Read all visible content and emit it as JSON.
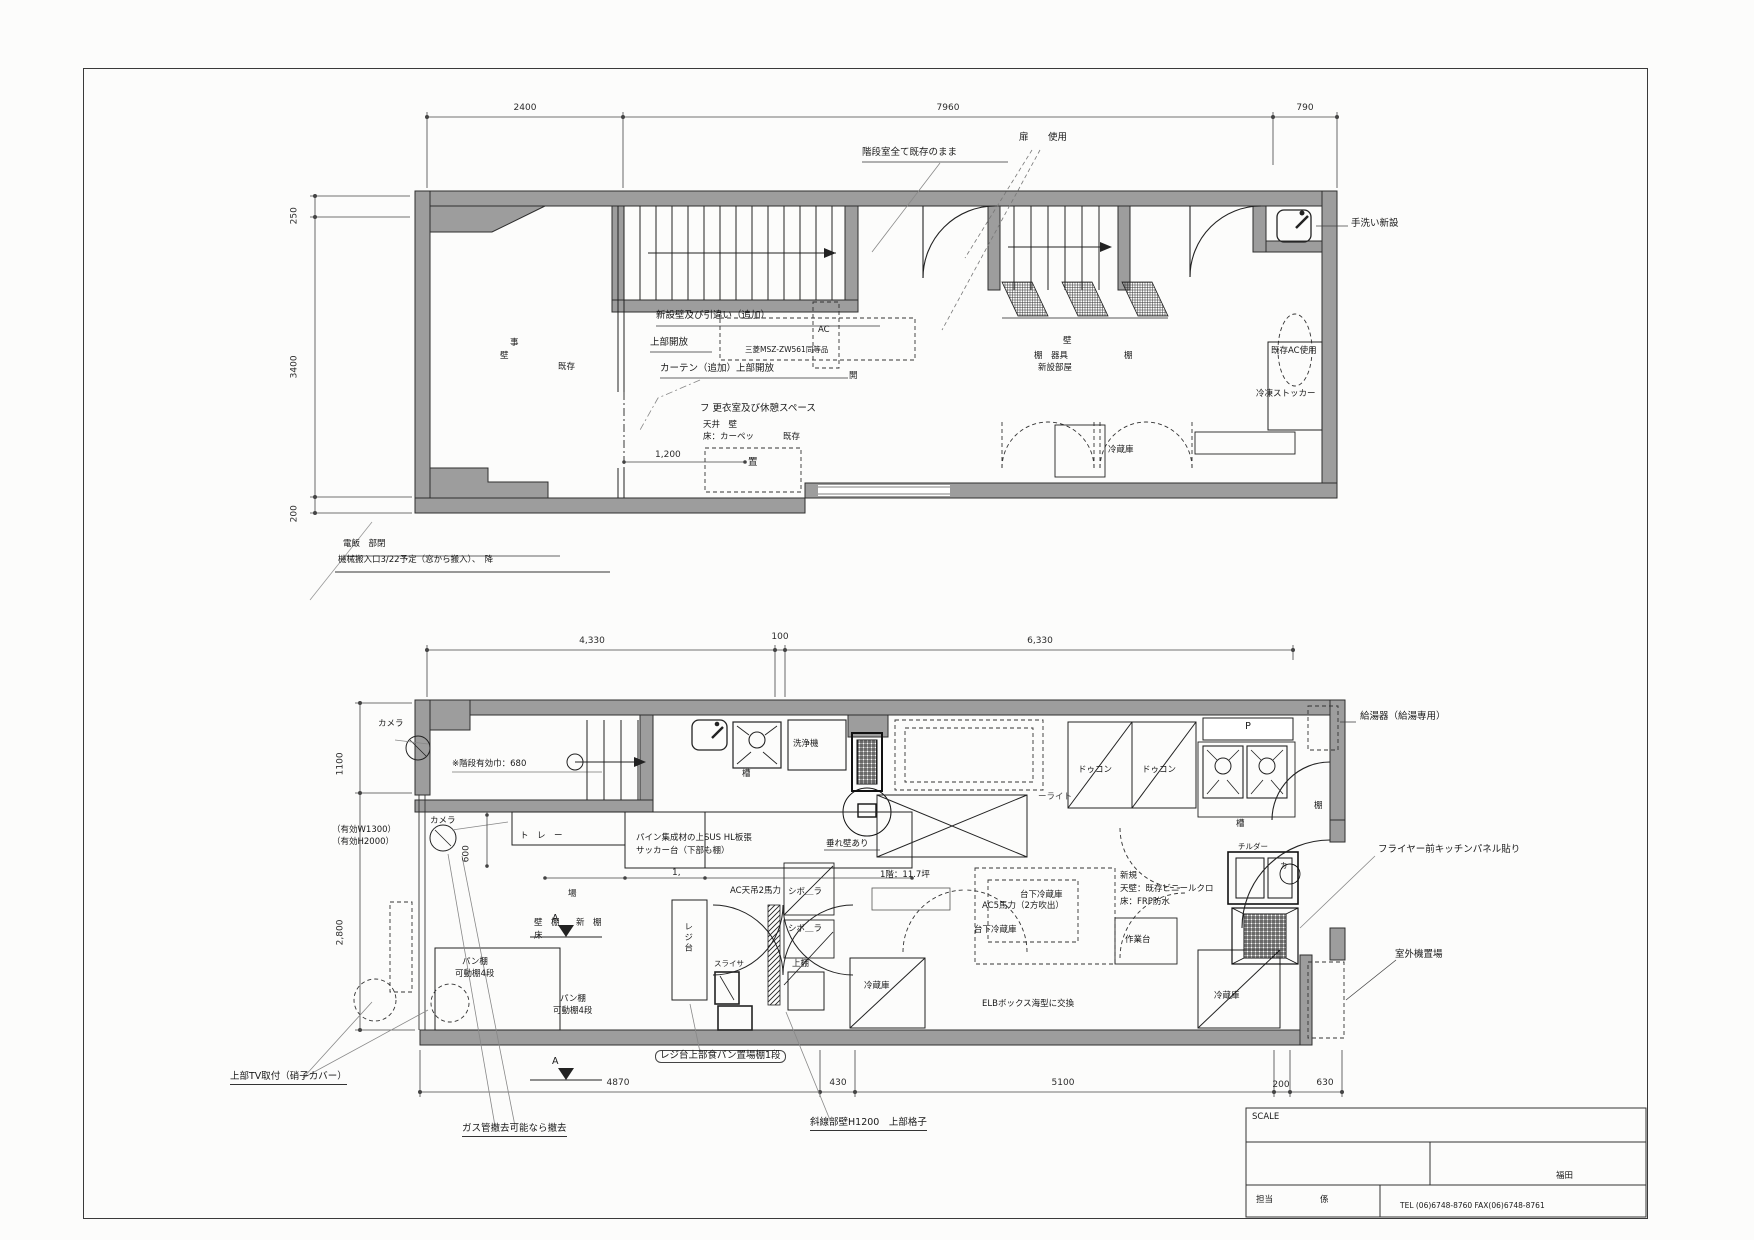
{
  "sheet": {
    "titleblock": {
      "scale": "SCALE",
      "tanto": "担当",
      "kakari": "係",
      "name": "福田",
      "tel": "TEL (06)6748-8760  FAX(06)6748-8761"
    },
    "notes": {
      "note1a": "電飯　部閉",
      "note1b": "機械搬入口3/22予定（窓から搬入）、　降",
      "tv": "上部TV取付（硝子カバー）",
      "gas": "ガス管撤去可能なら撤去",
      "breadshelf": "レジ台上部食パン置場棚1段",
      "hatch": "斜線部壁H1200　上部格子"
    }
  },
  "plan2f": {
    "dims": {
      "top1": "2400",
      "top2": "7960",
      "top3": "790",
      "left1": "250",
      "left2": "3400",
      "left3": "200",
      "inner": "1,200"
    },
    "labels": {
      "stair_note": "階段室全て既存のまま",
      "door": "扉",
      "door_use": "使用",
      "handwash": "手洗い新設",
      "new_wall": "新設壁及び引違い（追加）",
      "upper_open": "上部開放",
      "curtain": "カーテン（追加）上部開放",
      "dressing": "フ 更衣室及び休憩スペース",
      "ceiling_wall": "天井　壁",
      "floor_carpet": "床：カーペッ",
      "existing1": "既存",
      "room_a": "事",
      "room_b": "壁",
      "room_c": "既存",
      "ac": "AC",
      "ac_model": "三菱MSZ-ZW561同等品",
      "open_char": "開",
      "wall2": "壁",
      "shelf_fixture": "棚　器具",
      "new_room": "新設部屋",
      "shelf2": "棚",
      "exist_ac": "既存AC使用",
      "freezer": "冷凍ストッカー",
      "oki": "置",
      "fridge": "冷蔵庫"
    }
  },
  "plan1f": {
    "dims": {
      "t1": "4,330",
      "t2": "100",
      "t3": "6,330",
      "b1": "4870",
      "b2": "430",
      "b3": "5100",
      "b4": "200",
      "b5": "630",
      "l1": "1100",
      "l2": "2,800",
      "v600": "600",
      "v1": "1,"
    },
    "labels": {
      "water_heater": "給湯器（給湯専用）",
      "camera1": "カメラ",
      "camera2": "カメラ",
      "stair_width": "※階段有効巾：680",
      "eff_w": "（有効W1300）",
      "eff_h": "（有効H2000）",
      "tray": "ト　レ　ー",
      "counter1": "パイン集成材の上SUS HL板張",
      "counter2": "サッカー台（下部も棚）",
      "washer": "洗浄機",
      "tank1": "槽",
      "tank2": "槽",
      "deck1": "ドゥコン",
      "deck2": "ドゥコン",
      "p": "P",
      "hanging_wall": "垂れ壁あり",
      "area": "1階：11.7坪",
      "ac_ceiling": "AC天吊2馬力",
      "sibo1": "シボ＿ラ",
      "sibo2": "シボ＿ラ",
      "ba": "場",
      "wall_shelf": "壁　棚",
      "new_shelf": "新　棚",
      "floor": "床",
      "light_frag": "ーライト",
      "bread1a": "パン棚",
      "bread1b": "可動棚4段",
      "bread2a": "パン棚",
      "bread2b": "可動棚4段",
      "register": "レジ台",
      "slicer": "スライサ",
      "upper_shelf": "上棚",
      "fridge_l": "冷蔵庫",
      "fridge_r": "冷蔵庫",
      "elb": "ELBボックス海型に交換",
      "under_fridge1": "台下冷蔵庫",
      "under_fridge2": "台下冷蔵庫",
      "ac5": "AC5馬力（2方吹出）",
      "new_note": "新規",
      "wall_vinyl": "天壁：既存ビニールクロ",
      "floor_frp": "床：FRP防水",
      "worktable": "作業台",
      "chiller": "チルダー",
      "ka": "カ",
      "shelf": "棚",
      "fryer_panel": "フライヤー前キッチンパネル貼り",
      "outdoor": "室外機置場",
      "a_mark1": "A",
      "a_mark2": "A"
    }
  }
}
